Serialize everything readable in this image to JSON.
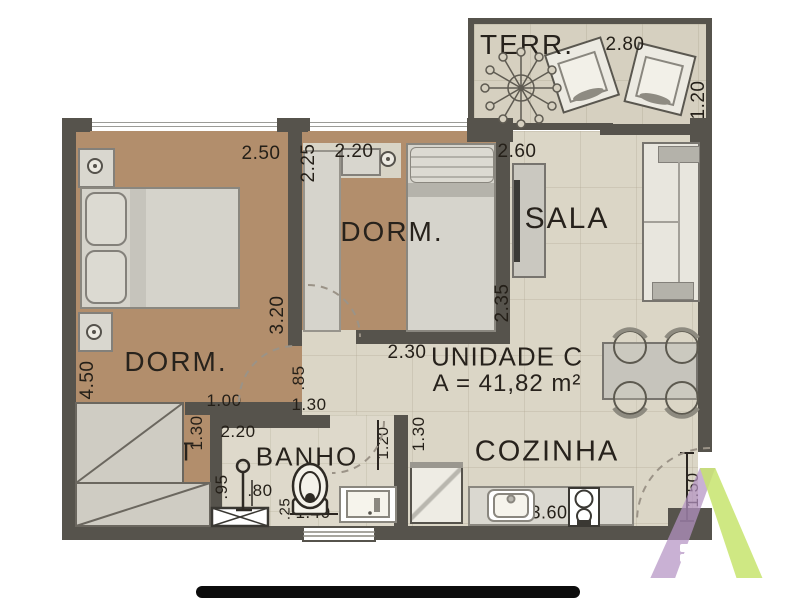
{
  "title": {
    "unit": "UNIDADE C",
    "area": "A = 41,82 m²"
  },
  "rooms": {
    "terrace": "TERR.",
    "dorm1": "DORM.",
    "dorm2": "DORM.",
    "sala": "SALA",
    "closet": "CLOSET",
    "banho": "BANHO",
    "cozinha": "COZINHA"
  },
  "dims": {
    "terr_w": "2.80",
    "terr_d": "1.20",
    "dorm1_w": "2.50",
    "dorm1_l": "4.50",
    "dorm1_wall": "3.20",
    "dorm2_side": "2.25",
    "dorm2_w": "2.20",
    "dorm2_b": "2.30",
    "sala_w": "2.60",
    "sala_h": "2.35",
    "hall_h": ".85",
    "hall_a": "1.00",
    "hall_b": "1.30",
    "closet_side": "1.30",
    "closet_w": "1.50",
    "banho_w": "2.20",
    "shower_d": ".95",
    "shower_w": ".80",
    "wc_gap": ".25",
    "banho_b": "1.40",
    "banho_r1": "1.20",
    "banho_r2": "1.30",
    "counter_w": "3.60",
    "entry_d": "1.50"
  },
  "colors": {
    "wall": "#56534c",
    "floor_wood": "#b28e6c",
    "floor_tile": "#dbd6c6",
    "logo_purple": "#b493c4",
    "logo_green": "#c7e46d"
  }
}
